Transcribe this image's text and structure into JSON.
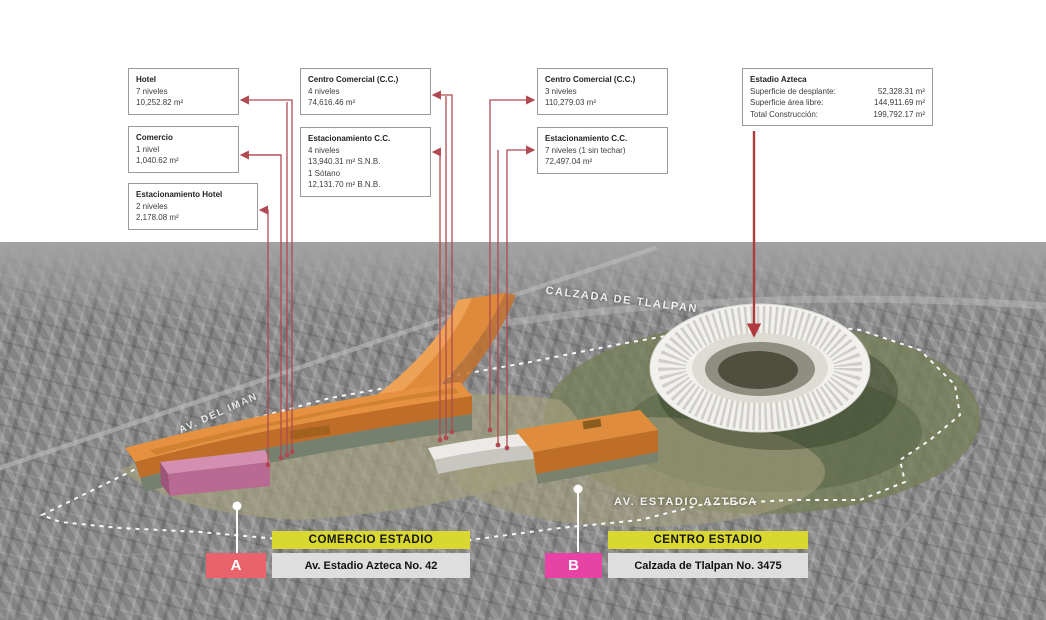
{
  "callouts": [
    {
      "title": "Hotel",
      "lines": [
        "7 niveles",
        "10,252.82 m²"
      ]
    },
    {
      "title": "Comercio",
      "lines": [
        "1 nivel",
        "1,040.62 m²"
      ]
    },
    {
      "title": "Estacionamiento Hotel",
      "lines": [
        "2 niveles",
        "2,178.08 m²"
      ]
    },
    {
      "title": "Centro Comercial (C.C.)",
      "lines": [
        "4 niveles",
        "74,616.46 m²"
      ]
    },
    {
      "title": "Estacionamiento C.C.",
      "lines": [
        "4 niveles",
        "13,940.31 m²  S.N.B.",
        "1 Sótano",
        "12,131.70 m²  B.N.B."
      ]
    },
    {
      "title": "Centro Comercial (C.C.)",
      "lines": [
        "3 niveles",
        "110,279.03 m²"
      ]
    },
    {
      "title": "Estacionamiento C.C.",
      "lines": [
        "7 niveles (1 sin techar)",
        "72,497.04 m²"
      ]
    }
  ],
  "estadio_box": {
    "title": "Estadio Azteca",
    "rows": [
      {
        "label": "Superficie de desplante:",
        "value": "52,328.31 m²"
      },
      {
        "label": "Superficie área libre:",
        "value": "144,911.69 m²"
      },
      {
        "label": "Total Construcción:",
        "value": "199,792.17 m²"
      }
    ]
  },
  "map_labels": {
    "calzada_de_tlalpan": "CALZADA DE TLALPAN",
    "av_del_iman": "AV. DEL IMAN",
    "av_estadio_azteca": "AV. ESTADIO AZTECA"
  },
  "sites": [
    {
      "zone_label": "COMERCIO ESTADIO",
      "marker": "A",
      "address": "Av. Estadio Azteca No. 42"
    },
    {
      "zone_label": "CENTRO ESTADIO",
      "marker": "B",
      "address": "Calzada de Tlalpan No. 3475"
    }
  ],
  "colors": {
    "leader_red": "#b04a52",
    "estadio_arrow_red": "#b13a3f",
    "marker_a_bg": "#e8636c",
    "marker_b_bg": "#e643a4",
    "zone_label_bg": "#d8d831",
    "address_bg": "#dedede",
    "building_orange": "#df8d3c",
    "building_pink": "#c87da8",
    "stadium_fill": "#f2f1ed"
  }
}
